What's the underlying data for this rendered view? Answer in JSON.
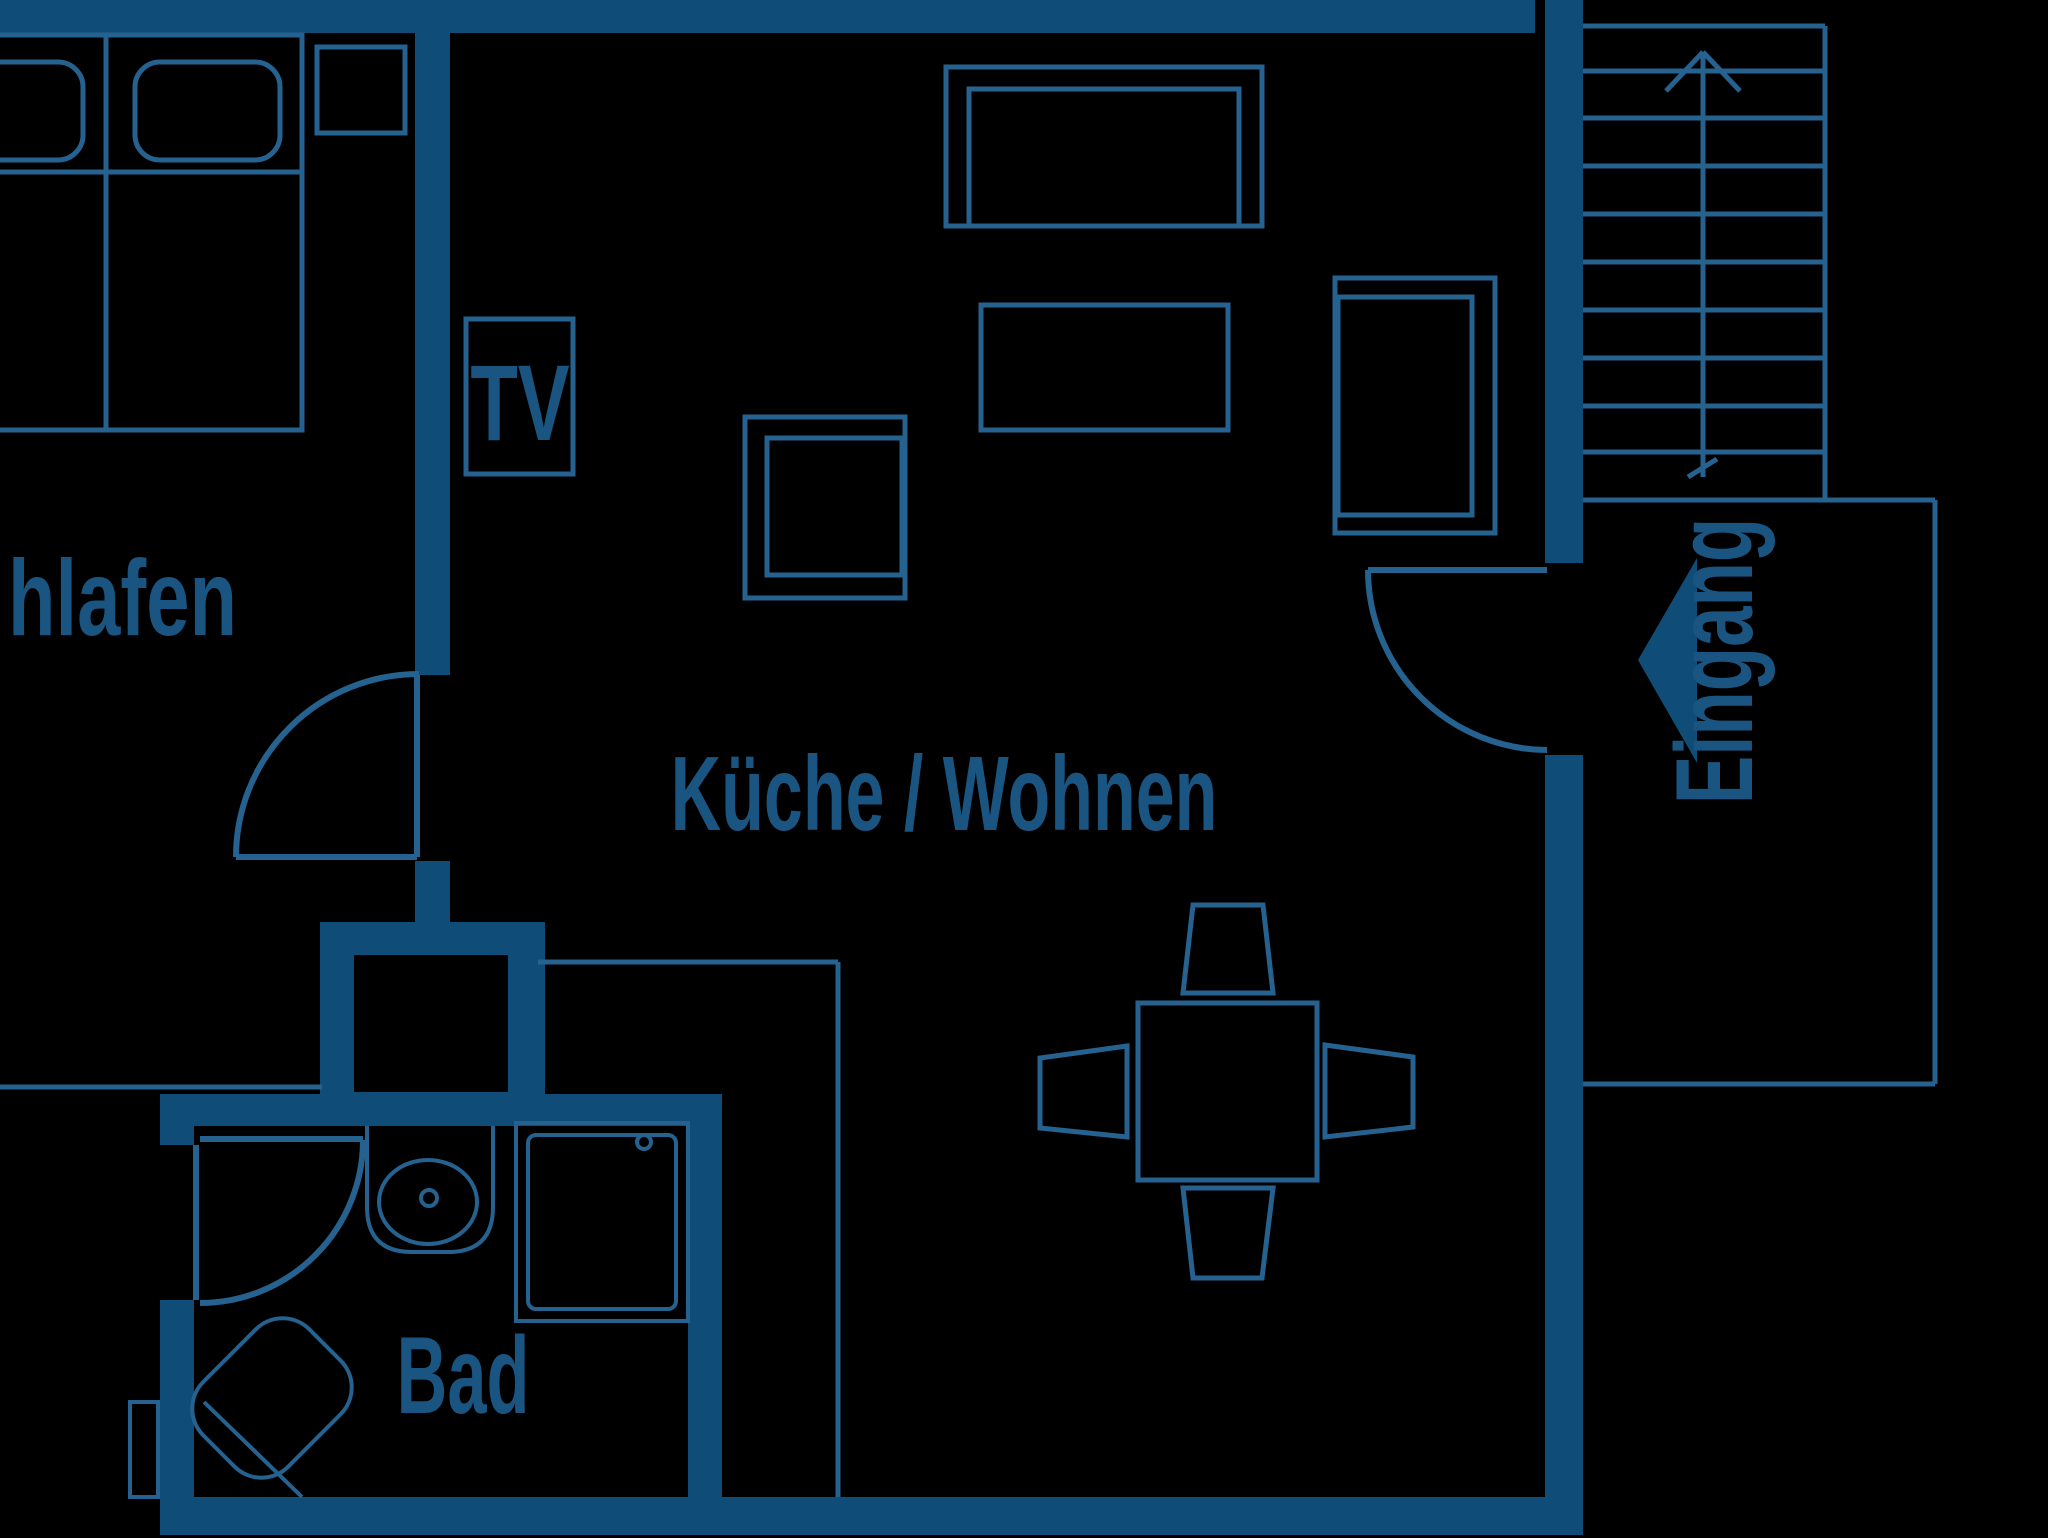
{
  "palette": {
    "background": "#000000",
    "wall": "#0f4c78",
    "line": "#266290",
    "text": "#1a5480"
  },
  "title": "Apartment floor plan",
  "rooms": {
    "bedroom": {
      "label": "hlafen",
      "full_word": "Schlafen",
      "furniture": [
        "double-bed",
        "pillow",
        "pillow",
        "nightstand"
      ]
    },
    "living": {
      "label": "Küche / Wohnen",
      "tv_label": "TV",
      "furniture": [
        "tv-board",
        "sofa",
        "coffee-table",
        "side-table",
        "armchair",
        "dining-table",
        "chair",
        "chair",
        "chair",
        "chair",
        "kitchen-counter"
      ]
    },
    "bath": {
      "label": "Bad",
      "furniture": [
        "sink",
        "shower",
        "bath-mat"
      ]
    },
    "entrance": {
      "label": "Eingang",
      "symbols": [
        "entry-arrow",
        "entry-door"
      ]
    },
    "staircase": {
      "steps": 10,
      "symbols": [
        "up-arrow"
      ]
    }
  }
}
